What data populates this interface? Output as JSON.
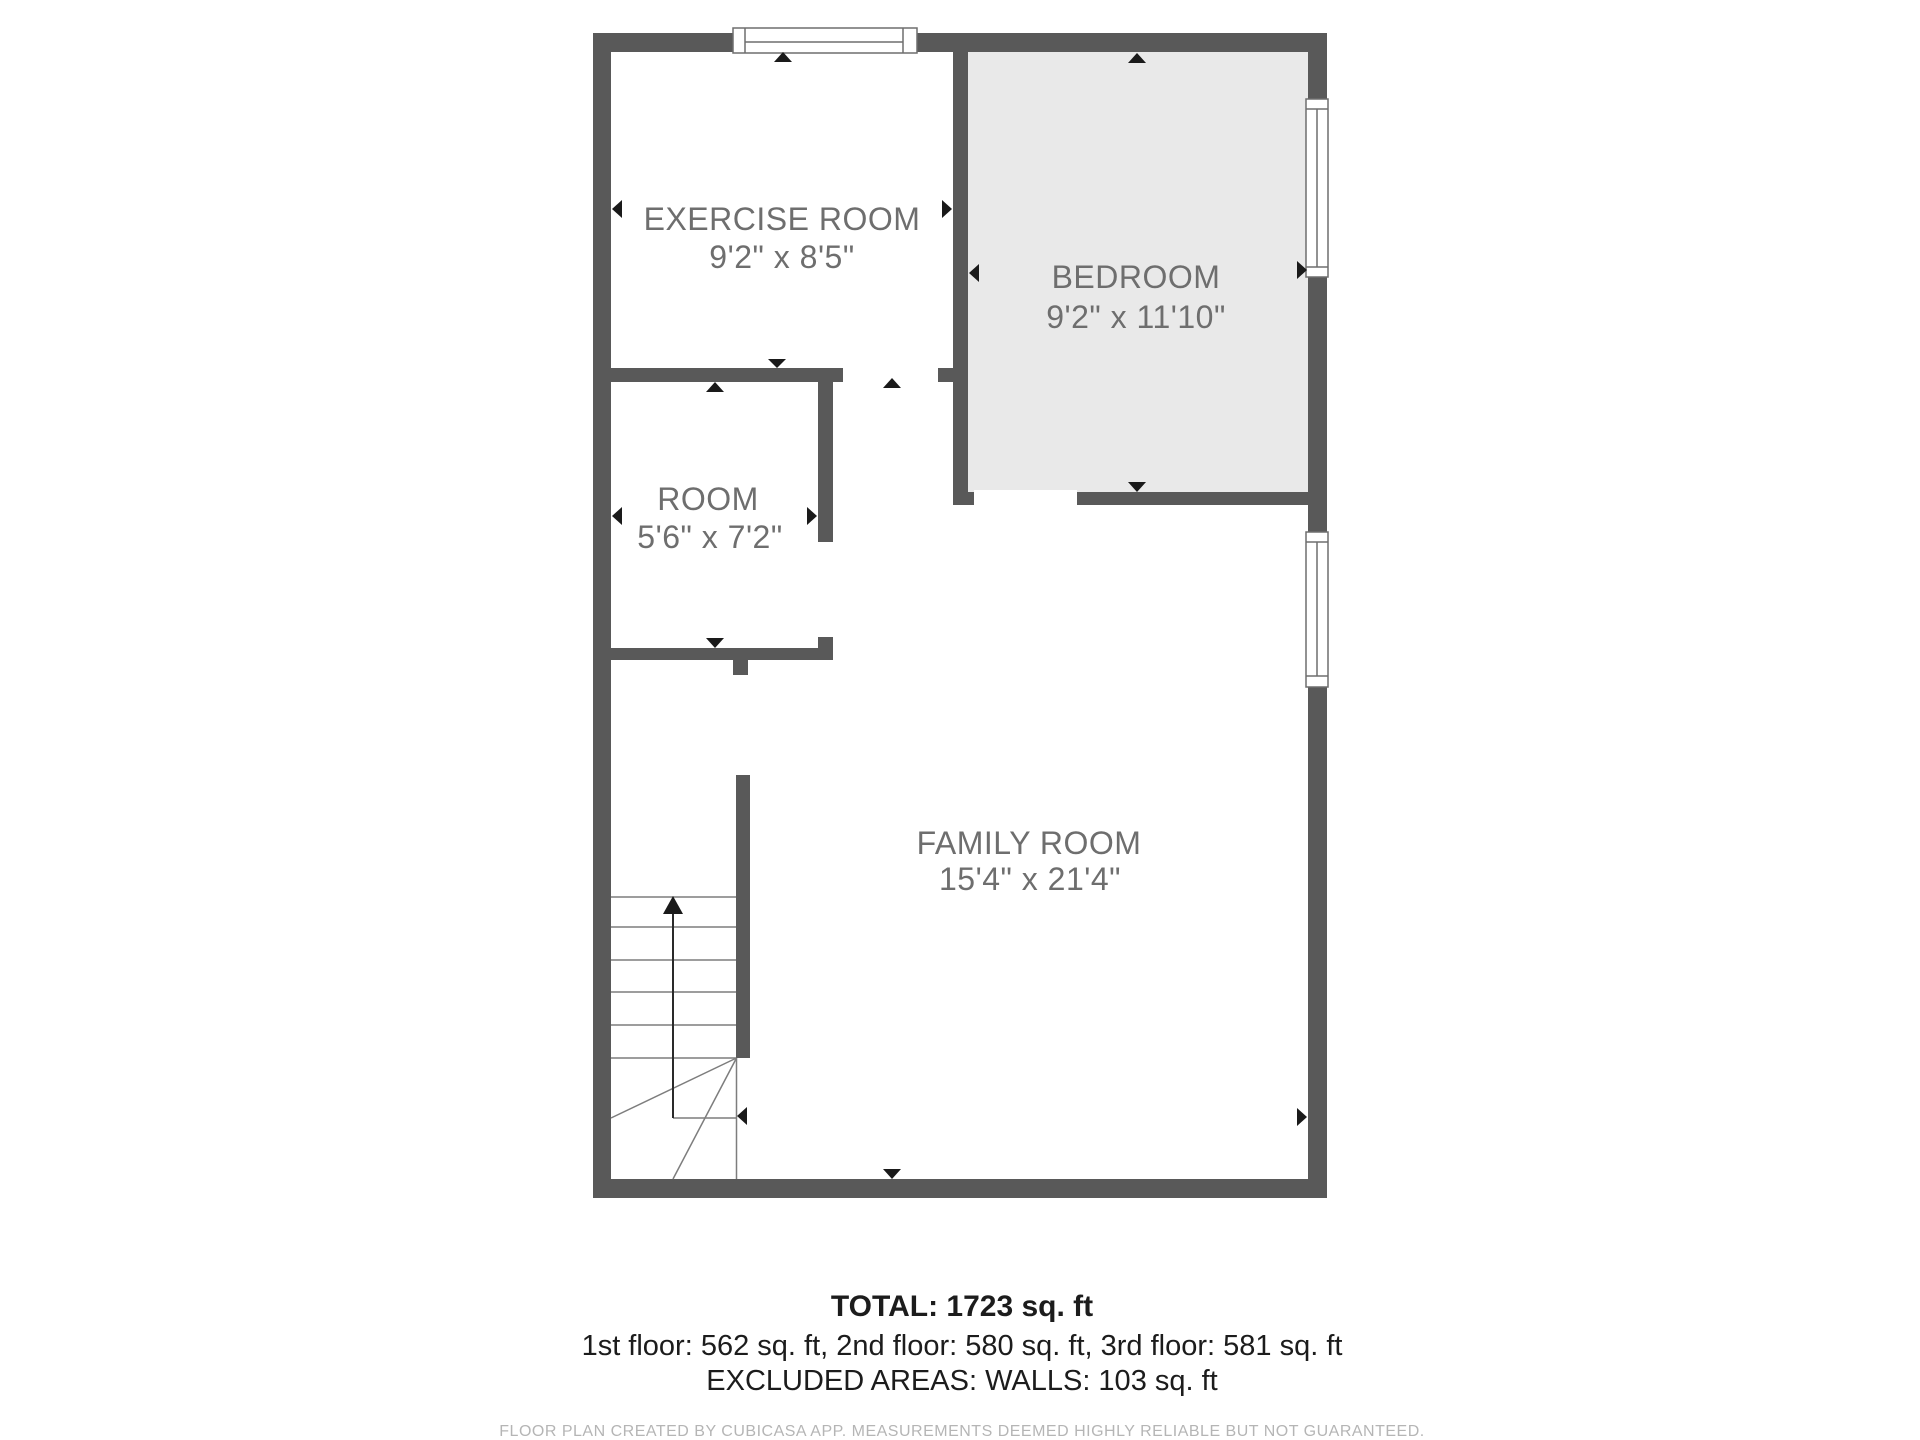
{
  "floor_plan": {
    "rooms": [
      {
        "name": "EXERCISE ROOM",
        "dimensions": "9'2\" x 8'5\""
      },
      {
        "name": "BEDROOM",
        "dimensions": "9'2\" x 11'10\""
      },
      {
        "name": "ROOM",
        "dimensions": "5'6\" x 7'2\""
      },
      {
        "name": "FAMILY ROOM",
        "dimensions": "15'4\" x 21'4\""
      }
    ],
    "features": {
      "stairs": "staircase with up direction arrow",
      "windows": [
        "top wall window",
        "bedroom right wall window",
        "family room right wall window"
      ],
      "doors": [
        "exercise room opening",
        "bedroom opening",
        "room opening",
        "stair hall opening"
      ]
    }
  },
  "summary": {
    "total": "TOTAL: 1723 sq. ft",
    "floors": "1st floor: 562 sq. ft, 2nd floor: 580 sq. ft, 3rd floor: 581 sq. ft",
    "excluded": "EXCLUDED AREAS: WALLS: 103 sq. ft"
  },
  "footer": {
    "disclaimer": "FLOOR PLAN CREATED BY CUBICASA APP. MEASUREMENTS DEEMED HIGHLY RELIABLE BUT NOT GUARANTEED."
  },
  "colors": {
    "wall": "#595959",
    "bedroom_fill": "#e9e9e9",
    "room_fill": "#ffffff",
    "label_text": "#6e6e6e",
    "summary_text": "#1c1c1c",
    "disclaimer_text": "#b5b5b5",
    "arrow": "#1a1a1a"
  }
}
